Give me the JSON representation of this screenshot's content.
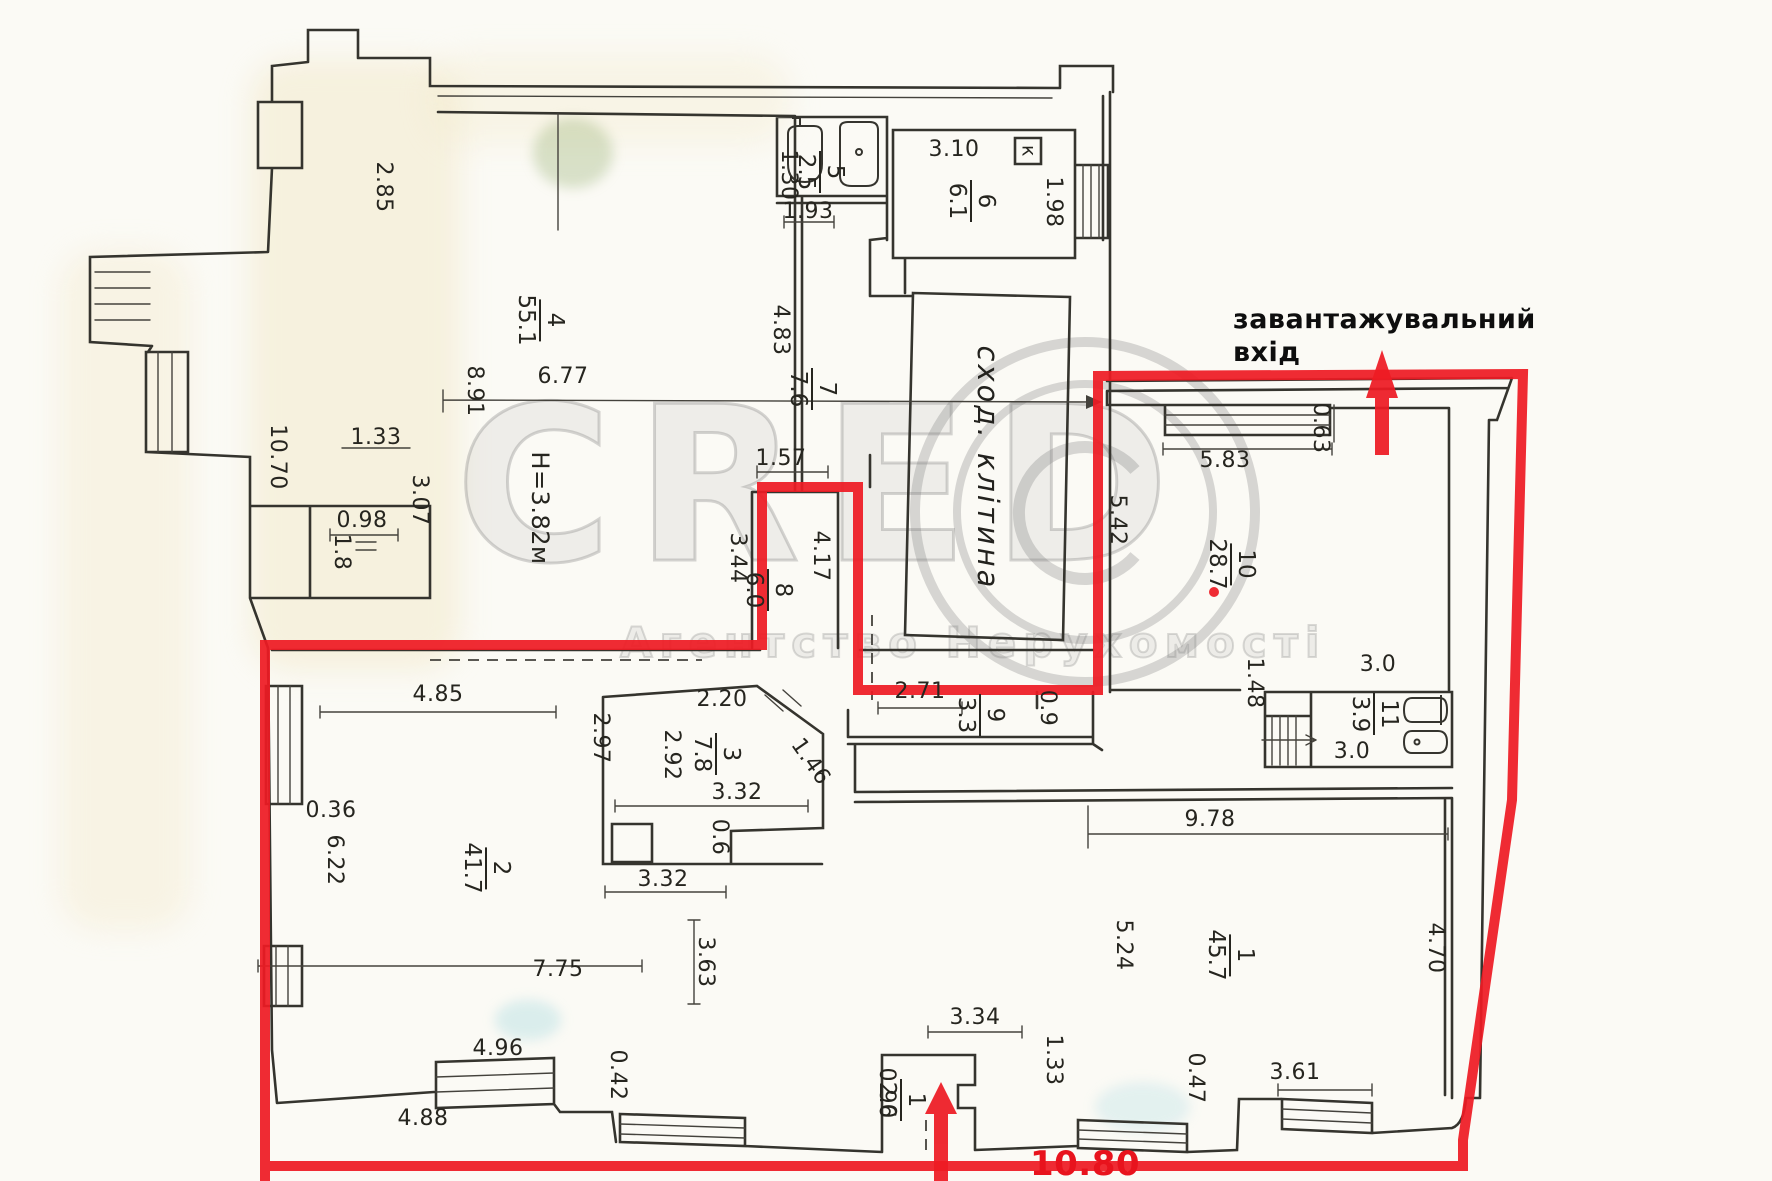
{
  "plan": {
    "colors": {
      "red_outline": "#ee1b24",
      "red_text": "#e8131d",
      "ink": "#35342e",
      "dim_text": "#26251f",
      "watermark": "#7d7d7d",
      "paper": "#fbfaf5"
    },
    "annotations": {
      "loading_entrance_line1": "завантажувальний",
      "loading_entrance_line2": "вхід",
      "stairwell": "сход. клітина"
    },
    "watermark": {
      "brand": "CRED",
      "subtitle": "Агентство Нерухомості"
    },
    "rooms": [
      {
        "num": "4",
        "area": "55.1",
        "x": 540,
        "y": 320
      },
      {
        "num": "5",
        "area": "2.5",
        "x": 820,
        "y": 172
      },
      {
        "num": "6",
        "area": "6.1",
        "x": 971,
        "y": 201
      },
      {
        "num": "7",
        "area": "7.6",
        "x": 812,
        "y": 389
      },
      {
        "num": "8",
        "area": "6.0",
        "x": 768,
        "y": 590
      },
      {
        "num": "2",
        "area": "41.7",
        "x": 486,
        "y": 868
      },
      {
        "num": "3",
        "area": "7.8",
        "x": 716,
        "y": 754
      },
      {
        "num": "9",
        "area": "3.3",
        "x": 980,
        "y": 715
      },
      {
        "num": "10",
        "area": "28.7",
        "x": 1231,
        "y": 564
      },
      {
        "num": "11",
        "area": "3.9",
        "x": 1374,
        "y": 714
      },
      {
        "num": "1",
        "area": "45.7",
        "x": 1230,
        "y": 955
      },
      {
        "num": "1",
        "area": "2.0",
        "x": 901,
        "y": 1100
      }
    ],
    "labels": [
      {
        "t": "2.85",
        "x": 383,
        "y": 187,
        "r": 90
      },
      {
        "t": "1.33",
        "x": 376,
        "y": 438,
        "r": 0
      },
      {
        "t": "3.07",
        "x": 419,
        "y": 500,
        "r": 90
      },
      {
        "t": "10.70",
        "x": 277,
        "y": 457,
        "r": 90
      },
      {
        "t": "0.98",
        "x": 362,
        "y": 521,
        "r": 0
      },
      {
        "t": "1.8",
        "x": 341,
        "y": 552,
        "r": 90
      },
      {
        "t": "8.91",
        "x": 474,
        "y": 391,
        "r": 90
      },
      {
        "t": "6.77",
        "x": 563,
        "y": 377,
        "r": 0
      },
      {
        "t": "4.85",
        "x": 438,
        "y": 695,
        "r": 0
      },
      {
        "t": "0.36",
        "x": 331,
        "y": 811,
        "r": 0
      },
      {
        "t": "6.22",
        "x": 334,
        "y": 860,
        "r": 90
      },
      {
        "t": "2.97",
        "x": 600,
        "y": 738,
        "r": 90
      },
      {
        "t": "2.92",
        "x": 671,
        "y": 755,
        "r": 90
      },
      {
        "t": "2.20",
        "x": 722,
        "y": 700,
        "r": 0
      },
      {
        "t": "3.32",
        "x": 737,
        "y": 793,
        "r": 0
      },
      {
        "t": "0.6",
        "x": 719,
        "y": 837,
        "r": 90
      },
      {
        "t": "3.32",
        "x": 663,
        "y": 880,
        "r": 0
      },
      {
        "t": "3.63",
        "x": 705,
        "y": 962,
        "r": 90
      },
      {
        "t": "1.46",
        "x": 810,
        "y": 762,
        "r": 55
      },
      {
        "t": "7.75",
        "x": 558,
        "y": 970,
        "r": 0
      },
      {
        "t": "4.96",
        "x": 498,
        "y": 1049,
        "r": 0
      },
      {
        "t": "0.42",
        "x": 617,
        "y": 1075,
        "r": 90
      },
      {
        "t": "4.88",
        "x": 423,
        "y": 1119,
        "r": 0
      },
      {
        "t": "1.30",
        "x": 788,
        "y": 175,
        "r": 90
      },
      {
        "t": "1.93",
        "x": 808,
        "y": 212,
        "r": 0
      },
      {
        "t": "1.57",
        "x": 781,
        "y": 459,
        "r": 0
      },
      {
        "t": "4.83",
        "x": 780,
        "y": 330,
        "r": 90
      },
      {
        "t": "3.44",
        "x": 737,
        "y": 558,
        "r": 90
      },
      {
        "t": "4.17",
        "x": 820,
        "y": 556,
        "r": 90
      },
      {
        "t": "3.10",
        "x": 954,
        "y": 150,
        "r": 0
      },
      {
        "t": "1.98",
        "x": 1053,
        "y": 202,
        "r": 90
      },
      {
        "t": "2.71",
        "x": 920,
        "y": 692,
        "r": 0
      },
      {
        "t": "0.9",
        "x": 1047,
        "y": 708,
        "r": 90
      },
      {
        "t": "9.78",
        "x": 1210,
        "y": 820,
        "r": 0
      },
      {
        "t": "5.24",
        "x": 1123,
        "y": 945,
        "r": 90
      },
      {
        "t": "3.34",
        "x": 975,
        "y": 1018,
        "r": 0
      },
      {
        "t": "1.33",
        "x": 1053,
        "y": 1060,
        "r": 90
      },
      {
        "t": "0.96",
        "x": 886,
        "y": 1093,
        "r": 90
      },
      {
        "t": "0.47",
        "x": 1195,
        "y": 1078,
        "r": 90
      },
      {
        "t": "3.61",
        "x": 1295,
        "y": 1073,
        "r": 0
      },
      {
        "t": "4.70",
        "x": 1435,
        "y": 948,
        "r": 90
      },
      {
        "t": "5.83",
        "x": 1225,
        "y": 461,
        "r": 0
      },
      {
        "t": "0.63",
        "x": 1320,
        "y": 428,
        "r": 90
      },
      {
        "t": "5.42",
        "x": 1117,
        "y": 520,
        "r": 90
      },
      {
        "t": "3.0",
        "x": 1378,
        "y": 665,
        "r": 0
      },
      {
        "t": "3.0",
        "x": 1352,
        "y": 752,
        "r": 0
      },
      {
        "t": "1.48",
        "x": 1254,
        "y": 683,
        "r": 90
      },
      {
        "t": "Н=3.82м",
        "x": 540,
        "y": 508,
        "r": 90,
        "s": 24
      },
      {
        "t": "к",
        "x": 1028,
        "y": 151,
        "r": 90,
        "s": 19
      },
      {
        "t": "10.80",
        "x": 1085,
        "y": 1164,
        "r": 0,
        "s": 34,
        "c": "red"
      }
    ]
  }
}
